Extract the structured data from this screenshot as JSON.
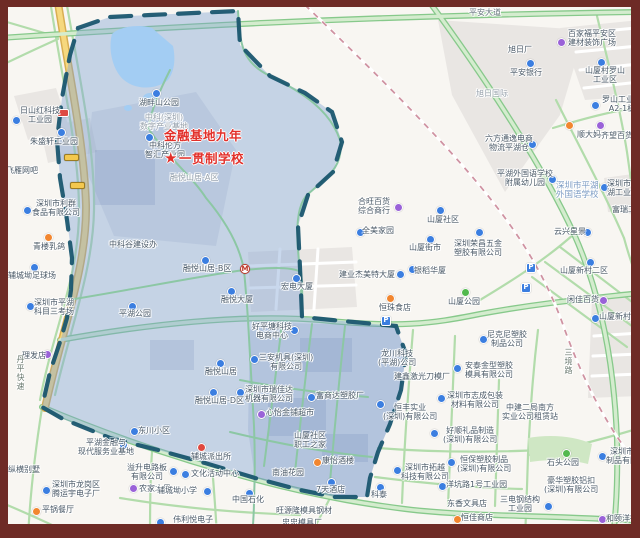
{
  "theme": {
    "frame_color": "#6e2b26",
    "zone_fill": "#7fa3d4",
    "zone_border": "#1a566f",
    "school_red": "#e2302a",
    "marker_colors": {
      "blue": "#3b7ee0",
      "purple": "#9a62d8",
      "orange": "#f2862f",
      "green": "#52b94e",
      "red": "#e0483e"
    }
  },
  "school": {
    "x": 164,
    "y": 129,
    "line1": "金融基地九年",
    "line2": "一贯制学校",
    "star": "★"
  },
  "map": {
    "labels": [
      {
        "x": 20,
        "y": 106,
        "lines": [
          "日山红科技",
          "工业园"
        ],
        "m": {
          "x": 12,
          "y": 116,
          "t": "blue"
        }
      },
      {
        "x": 30,
        "y": 137,
        "lines": [
          "朱盛轩工业园"
        ],
        "m": {
          "x": 57,
          "y": 128,
          "t": "blue"
        }
      },
      {
        "x": 6,
        "y": 166,
        "lines": [
          "飞雁网吧"
        ]
      },
      {
        "x": 32,
        "y": 199,
        "lines": [
          "深圳市利群",
          "食品有限公司"
        ],
        "m": {
          "x": 23,
          "y": 206,
          "t": "blue"
        }
      },
      {
        "x": 33,
        "y": 242,
        "lines": [
          "青楼乳鸽"
        ],
        "m": {
          "x": 44,
          "y": 233,
          "t": "orange"
        }
      },
      {
        "x": 8,
        "y": 271,
        "lines": [
          "辅城坳足球场"
        ],
        "m": {
          "x": 30,
          "y": 263,
          "t": "blue"
        }
      },
      {
        "x": 34,
        "y": 298,
        "lines": [
          "深圳市平湖",
          "科目三考场"
        ],
        "m": {
          "x": 26,
          "y": 302,
          "t": "blue"
        }
      },
      {
        "x": 22,
        "y": 351,
        "lines": [
          "理发店"
        ],
        "m": {
          "x": 43,
          "y": 350,
          "t": "purple"
        }
      },
      {
        "x": 8,
        "y": 465,
        "lines": [
          "纵横别墅"
        ]
      },
      {
        "x": 52,
        "y": 480,
        "lines": [
          "深圳市龙岗区",
          "腾运宇电子厂"
        ],
        "m": {
          "x": 42,
          "y": 486,
          "t": "blue"
        }
      },
      {
        "x": 42,
        "y": 505,
        "lines": [
          "平锅餐厅"
        ],
        "m": {
          "x": 32,
          "y": 507,
          "t": "orange"
        }
      },
      {
        "x": 78,
        "y": 438,
        "lines": [
          "平湖金融与",
          "现代服务业基地"
        ],
        "m": {
          "x": 119,
          "y": 441,
          "t": "blue"
        }
      },
      {
        "x": 138,
        "y": 426,
        "lines": [
          "东川小区"
        ],
        "m": {
          "x": 130,
          "y": 427,
          "t": "blue"
        }
      },
      {
        "x": 127,
        "y": 463,
        "lines": [
          "溢升电路板",
          "有限公司"
        ],
        "m": {
          "x": 169,
          "y": 467,
          "t": "blue"
        }
      },
      {
        "x": 139,
        "y": 484,
        "lines": [
          "农家水果"
        ],
        "m": {
          "x": 129,
          "y": 484,
          "t": "purple"
        }
      },
      {
        "x": 191,
        "y": 469,
        "lines": [
          "文化活动中心"
        ],
        "m": {
          "x": 181,
          "y": 470,
          "t": "blue"
        }
      },
      {
        "x": 157,
        "y": 486,
        "lines": [
          "辅城坳小学"
        ],
        "m": {
          "x": 203,
          "y": 487,
          "t": "blue"
        }
      },
      {
        "x": 232,
        "y": 495,
        "lines": [
          "中国石化"
        ],
        "m": {
          "x": 245,
          "y": 489,
          "t": "blue"
        }
      },
      {
        "x": 166,
        "y": 515,
        "lines": [
          "伟利悦电子",
          "(深圳)有限公司"
        ],
        "m": {
          "x": 156,
          "y": 518,
          "t": "blue"
        }
      },
      {
        "x": 276,
        "y": 506,
        "lines": [
          "旺源隆模具钢材"
        ]
      },
      {
        "x": 282,
        "y": 518,
        "lines": [
          "忠忠模具厂"
        ]
      },
      {
        "x": 191,
        "y": 452,
        "lines": [
          "辅城派出所"
        ],
        "m": {
          "x": 197,
          "y": 443,
          "t": "red"
        }
      },
      {
        "x": 109,
        "y": 240,
        "lines": [
          "中科谷建设办"
        ]
      },
      {
        "x": 119,
        "y": 309,
        "lines": [
          "平湖公园"
        ],
        "m": {
          "x": 128,
          "y": 302,
          "t": "blue"
        }
      },
      {
        "x": 183,
        "y": 264,
        "lines": [
          "融悦山居-B区"
        ],
        "m": {
          "x": 201,
          "y": 256,
          "t": "blue"
        }
      },
      {
        "x": 221,
        "y": 295,
        "lines": [
          "融悦大厦"
        ],
        "m": {
          "x": 227,
          "y": 287,
          "t": "blue"
        }
      },
      {
        "x": 205,
        "y": 367,
        "lines": [
          "融悦山居"
        ],
        "m": {
          "x": 216,
          "y": 359,
          "t": "blue"
        }
      },
      {
        "x": 195,
        "y": 396,
        "lines": [
          "融悦山居-D区"
        ],
        "m": {
          "x": 209,
          "y": 388,
          "t": "blue"
        }
      },
      {
        "x": 170,
        "y": 173,
        "lines": [
          "融悦山居-A区"
        ],
        "cls": "ghost"
      },
      {
        "x": 145,
        "y": 141,
        "lines": [
          "中科伦方",
          "智汇产业园"
        ],
        "m": {
          "x": 145,
          "y": 133,
          "t": "blue"
        }
      },
      {
        "x": 139,
        "y": 98,
        "lines": [
          "湖畔山公园"
        ],
        "m": {
          "x": 152,
          "y": 89,
          "t": "blue"
        }
      },
      {
        "x": 140,
        "y": 113,
        "lines": [
          "中科(深圳)",
          "数字产业基地"
        ],
        "cls": "ghost"
      },
      {
        "x": 252,
        "y": 322,
        "lines": [
          "好平塘科技",
          "电商中心"
        ],
        "m": {
          "x": 290,
          "y": 326,
          "t": "blue"
        }
      },
      {
        "x": 281,
        "y": 282,
        "lines": [
          "宏电大厦"
        ],
        "m": {
          "x": 292,
          "y": 274,
          "t": "blue"
        }
      },
      {
        "x": 245,
        "y": 385,
        "lines": [
          "深圳市瑞佳达",
          "机器有限公司"
        ],
        "m": {
          "x": 236,
          "y": 388,
          "t": "blue"
        }
      },
      {
        "x": 266,
        "y": 408,
        "lines": [
          "心怡金铺超市"
        ],
        "m": {
          "x": 257,
          "y": 410,
          "t": "purple"
        }
      },
      {
        "x": 259,
        "y": 353,
        "lines": [
          "三安机具(深圳)",
          "有限公司"
        ],
        "m": {
          "x": 250,
          "y": 355,
          "t": "blue"
        }
      },
      {
        "x": 316,
        "y": 391,
        "lines": [
          "富商达塑胶厂"
        ],
        "m": {
          "x": 307,
          "y": 393,
          "t": "blue"
        }
      },
      {
        "x": 378,
        "y": 349,
        "lines": [
          "龙川科技",
          "(平湖)公司"
        ]
      },
      {
        "x": 383,
        "y": 403,
        "lines": [
          "恒丰实业",
          "(深圳)有限公司"
        ],
        "m": {
          "x": 376,
          "y": 400,
          "t": "blue"
        }
      },
      {
        "x": 394,
        "y": 372,
        "lines": [
          "建鑫激光刀模厂"
        ]
      },
      {
        "x": 487,
        "y": 330,
        "lines": [
          "尼克尼塑胶",
          "制品公司"
        ],
        "m": {
          "x": 479,
          "y": 335,
          "t": "blue"
        }
      },
      {
        "x": 465,
        "y": 361,
        "lines": [
          "安泰金型塑胶",
          "模具有限公司"
        ],
        "m": {
          "x": 453,
          "y": 364,
          "t": "blue"
        }
      },
      {
        "x": 447,
        "y": 391,
        "lines": [
          "深圳市志成包装",
          "材料有限公司"
        ],
        "m": {
          "x": 437,
          "y": 394,
          "t": "blue"
        }
      },
      {
        "x": 502,
        "y": 403,
        "lines": [
          "中建二局南方",
          "实业公司租赁站"
        ]
      },
      {
        "x": 443,
        "y": 426,
        "lines": [
          "好顺礼品制造",
          "(深圳)有限公司"
        ],
        "m": {
          "x": 430,
          "y": 429,
          "t": "blue"
        }
      },
      {
        "x": 401,
        "y": 463,
        "lines": [
          "深圳市拓越",
          "科技有限公司"
        ],
        "m": {
          "x": 393,
          "y": 466,
          "t": "blue"
        }
      },
      {
        "x": 457,
        "y": 455,
        "lines": [
          "恒保塑胶制品",
          "(深圳)有限公司"
        ],
        "m": {
          "x": 447,
          "y": 458,
          "t": "blue"
        }
      },
      {
        "x": 446,
        "y": 480,
        "lines": [
          "洋坑路1号工业园"
        ],
        "m": {
          "x": 438,
          "y": 482,
          "t": "blue"
        }
      },
      {
        "x": 500,
        "y": 495,
        "lines": [
          "三电钢结构",
          "工业园"
        ],
        "m": {
          "x": 544,
          "y": 502,
          "t": "blue"
        }
      },
      {
        "x": 544,
        "y": 476,
        "lines": [
          "豪华塑胶铝扣",
          "(深圳)有限公司"
        ]
      },
      {
        "x": 606,
        "y": 447,
        "lines": [
          "深圳市豪华",
          "制品有限公司"
        ],
        "m": {
          "x": 598,
          "y": 452,
          "t": "blue"
        }
      },
      {
        "x": 371,
        "y": 490,
        "lines": [
          "科泰"
        ],
        "m": {
          "x": 376,
          "y": 483,
          "t": "blue"
        }
      },
      {
        "x": 447,
        "y": 499,
        "lines": [
          "东香文具店"
        ]
      },
      {
        "x": 461,
        "y": 513,
        "lines": [
          "恒佳商店"
        ],
        "m": {
          "x": 453,
          "y": 515,
          "t": "orange"
        }
      },
      {
        "x": 606,
        "y": 514,
        "lines": [
          "和颐洋行"
        ],
        "m": {
          "x": 598,
          "y": 515,
          "t": "purple"
        }
      },
      {
        "x": 547,
        "y": 458,
        "lines": [
          "石头公园"
        ],
        "m": {
          "x": 562,
          "y": 449,
          "t": "green"
        }
      },
      {
        "x": 316,
        "y": 485,
        "lines": [
          "7天酒店"
        ],
        "m": {
          "x": 327,
          "y": 478,
          "t": "blue"
        }
      },
      {
        "x": 294,
        "y": 431,
        "lines": [
          "山厦社区",
          "职工之家"
        ]
      },
      {
        "x": 322,
        "y": 456,
        "lines": [
          "康怡酒楼"
        ],
        "m": {
          "x": 313,
          "y": 458,
          "t": "orange"
        }
      },
      {
        "x": 272,
        "y": 468,
        "lines": [
          "南油花园"
        ]
      },
      {
        "x": 508,
        "y": 45,
        "lines": [
          "旭日厂"
        ]
      },
      {
        "x": 510,
        "y": 68,
        "lines": [
          "平安银行"
        ],
        "m": {
          "x": 526,
          "y": 59,
          "t": "blue"
        }
      },
      {
        "x": 476,
        "y": 89,
        "lines": [
          "旭日国际"
        ],
        "cls": "ghost"
      },
      {
        "x": 568,
        "y": 29,
        "lines": [
          "百家福平安区",
          "建材装饰广场"
        ],
        "m": {
          "x": 557,
          "y": 38,
          "t": "purple"
        }
      },
      {
        "x": 585,
        "y": 66,
        "lines": [
          "山厦村罗山",
          "工业区"
        ],
        "m": {
          "x": 597,
          "y": 58,
          "t": "blue"
        }
      },
      {
        "x": 602,
        "y": 95,
        "lines": [
          "罗山工业区",
          "A2-1栋"
        ],
        "m": {
          "x": 591,
          "y": 101,
          "t": "blue"
        }
      },
      {
        "x": 485,
        "y": 134,
        "lines": [
          "六方通逸电商",
          "物流平湖仓"
        ],
        "m": {
          "x": 528,
          "y": 140,
          "t": "blue"
        }
      },
      {
        "x": 577,
        "y": 130,
        "lines": [
          "顺大妈"
        ],
        "m": {
          "x": 565,
          "y": 121,
          "t": "orange"
        }
      },
      {
        "x": 601,
        "y": 131,
        "lines": [
          "齐望百货"
        ],
        "m": {
          "x": 596,
          "y": 121,
          "t": "purple"
        }
      },
      {
        "x": 497,
        "y": 169,
        "lines": [
          "平湖外国语学校",
          "附属幼儿园"
        ],
        "m": {
          "x": 548,
          "y": 175,
          "t": "blue"
        }
      },
      {
        "x": 556,
        "y": 182,
        "lines": [
          "深圳市平湖",
          "外国语学校"
        ],
        "cls": "water"
      },
      {
        "x": 607,
        "y": 179,
        "lines": [
          "深圳市平",
          "湖工业园"
        ],
        "m": {
          "x": 600,
          "y": 183,
          "t": "blue"
        }
      },
      {
        "x": 612,
        "y": 205,
        "lines": [
          "富瑞工业"
        ]
      },
      {
        "x": 554,
        "y": 227,
        "lines": [
          "云兴星景"
        ],
        "m": {
          "x": 583,
          "y": 228,
          "t": "blue"
        }
      },
      {
        "x": 427,
        "y": 215,
        "lines": [
          "山厦社区"
        ],
        "m": {
          "x": 436,
          "y": 206,
          "t": "blue"
        }
      },
      {
        "x": 358,
        "y": 197,
        "lines": [
          "合旺百货",
          "综合商行"
        ],
        "m": {
          "x": 394,
          "y": 203,
          "t": "purple"
        }
      },
      {
        "x": 362,
        "y": 226,
        "lines": [
          "全美家园"
        ],
        "m": {
          "x": 356,
          "y": 228,
          "t": "blue"
        }
      },
      {
        "x": 409,
        "y": 243,
        "lines": [
          "山厦街市"
        ],
        "m": {
          "x": 426,
          "y": 235,
          "t": "blue"
        }
      },
      {
        "x": 454,
        "y": 239,
        "lines": [
          "深圳荣昌五金",
          "塑胶有限公司"
        ],
        "m": {
          "x": 475,
          "y": 228,
          "t": "blue"
        }
      },
      {
        "x": 560,
        "y": 266,
        "lines": [
          "山厦新村二区"
        ],
        "m": {
          "x": 586,
          "y": 258,
          "t": "blue"
        }
      },
      {
        "x": 567,
        "y": 295,
        "lines": [
          "闲佳百货"
        ],
        "m": {
          "x": 599,
          "y": 296,
          "t": "purple"
        }
      },
      {
        "x": 599,
        "y": 312,
        "lines": [
          "山厦新村"
        ],
        "m": {
          "x": 591,
          "y": 314,
          "t": "blue"
        }
      },
      {
        "x": 448,
        "y": 297,
        "lines": [
          "山厦公园"
        ],
        "m": {
          "x": 461,
          "y": 288,
          "t": "green"
        }
      },
      {
        "x": 379,
        "y": 303,
        "lines": [
          "恒珠食店"
        ],
        "m": {
          "x": 386,
          "y": 294,
          "t": "orange"
        }
      },
      {
        "x": 339,
        "y": 270,
        "lines": [
          "建业杰美特大厦"
        ],
        "m": {
          "x": 396,
          "y": 270,
          "t": "blue"
        }
      },
      {
        "x": 414,
        "y": 266,
        "lines": [
          "银稻华厦"
        ],
        "m": {
          "x": 408,
          "y": 265,
          "t": "blue"
        }
      },
      {
        "x": 469,
        "y": 8,
        "lines": [
          "平安大道"
        ],
        "cls": "roadh"
      },
      {
        "x": 16,
        "y": 355,
        "lines": [
          "丹平快速"
        ],
        "cls": "roadv",
        "vert": true
      },
      {
        "x": 564,
        "y": 348,
        "lines": [
          "三境路"
        ],
        "cls": "roadv",
        "vert": true
      }
    ],
    "extra_markers": [
      {
        "x": 240,
        "y": 264,
        "t": "metro",
        "glyph": "M"
      },
      {
        "x": 526,
        "y": 263,
        "t": "parking",
        "glyph": "P"
      },
      {
        "x": 521,
        "y": 283,
        "t": "parking",
        "glyph": "P"
      },
      {
        "x": 381,
        "y": 316,
        "t": "parking",
        "glyph": "P"
      },
      {
        "x": 57,
        "y": 109,
        "t": "badge-red",
        "glyph": ""
      },
      {
        "x": 64,
        "y": 154,
        "t": "badge-yellow",
        "glyph": ""
      },
      {
        "x": 70,
        "y": 182,
        "t": "badge-yellow",
        "glyph": ""
      }
    ]
  }
}
